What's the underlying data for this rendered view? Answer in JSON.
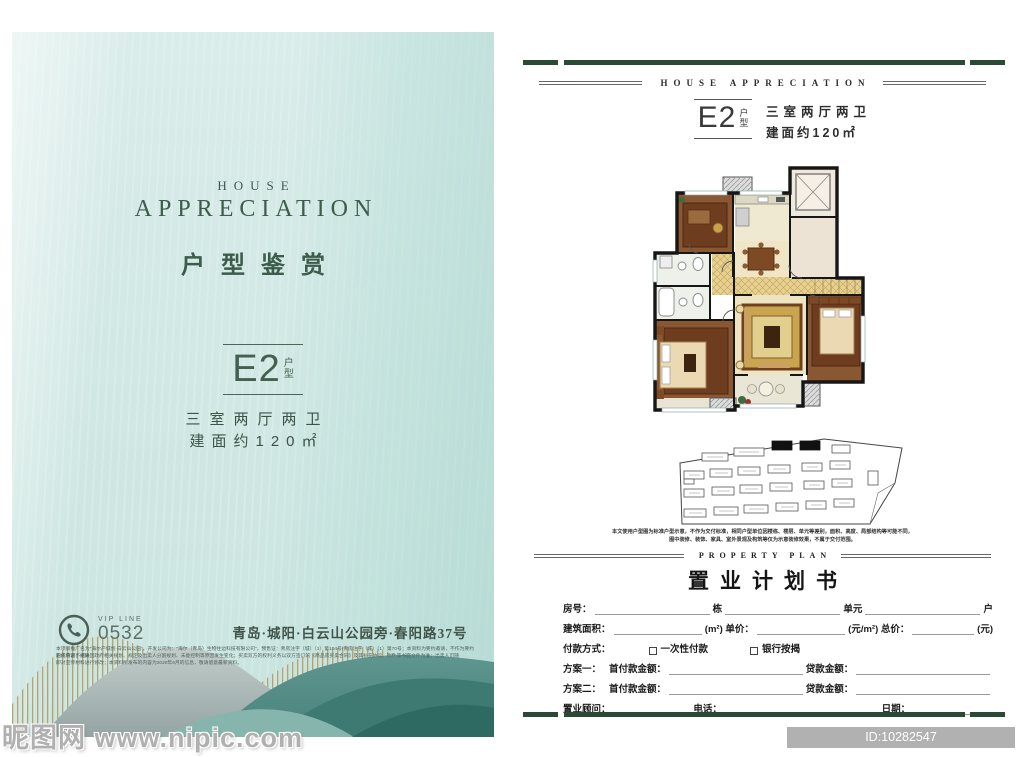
{
  "colors": {
    "page_teal": "#cfe7e3",
    "deep_green_bar": "#2a4a35",
    "title_green": "#3d5c4b",
    "gold_stripe": "#b49a63"
  },
  "left": {
    "house": "HOUSE",
    "appreciation": "APPRECIATION",
    "cn_title": "户型鉴赏",
    "unit": "E2",
    "unit_fu": "户",
    "unit_xing": "型",
    "spec_rooms": "三室两厅两卫",
    "spec_area": "建面约120㎡",
    "vip_label": "VIP LINE",
    "vip_number": "0532",
    "address": "青岛·城阳·白云山公园旁·春阳路37号",
    "fine_print_1": "本项目推广名为“海尔产城创·白云山公园”，开发公司为：“海尔（青岛）生物住边科技有限公司”，预售证：青房注字（城）（1）第104号/青房注字（城）（1）第70号；本资料为要约邀请，不作为要约的成承诺；相关",
    "fine_print_2": "宣传内容不排除因政府相关规划、规定及出卖人分割规划、未能控制等原因发生变化；买卖双方的权利义务以双方签订的《商品房买卖合同》及其补充协议、附件等书面文件为准；出卖人可随",
    "fine_print_3": "即对宣传材料进行修改；本资料所发布的内容为2020年6月的信息，敬请留意最新资料。"
  },
  "right": {
    "header": "HOUSE APPRECIATION",
    "unit": "E2",
    "unit_fu": "户",
    "unit_xing": "型",
    "spec_rooms": "三室两厅两卫",
    "spec_area": "建面约120㎡",
    "plan_note_1": "本文使用户型图为标准户型示意，不作为交付标准，相同户型单位因楼栋、楼层、单元等差别，面积、高度、局部结构等可能不同，",
    "plan_note_2": "图中装修、装饰、家具、室外景观及构筑等仅为示意装修效果，不属于交付范围。",
    "plan_en": "PROPERTY PLAN",
    "plan_cn": "置业计划书",
    "form": {
      "r1": [
        "房号：",
        "栋",
        "单元",
        "户"
      ],
      "r2": [
        "建筑面积：",
        "(m²) 单价：",
        "(元/m²) 总价：",
        "(元)"
      ],
      "r3": [
        "付款方式：",
        "一次性付款",
        "银行按揭"
      ],
      "r4": [
        "方案一：",
        "首付款金额：",
        "贷款金额："
      ],
      "r5": [
        "方案二：",
        "首付款金额：",
        "贷款金额："
      ],
      "r6": [
        "置业顾问：",
        "电话：",
        "日期："
      ]
    }
  },
  "watermark": {
    "site": "昵图网 www.nipic.com",
    "id_text": "ID:10282547 NO:20210712103909855102"
  }
}
